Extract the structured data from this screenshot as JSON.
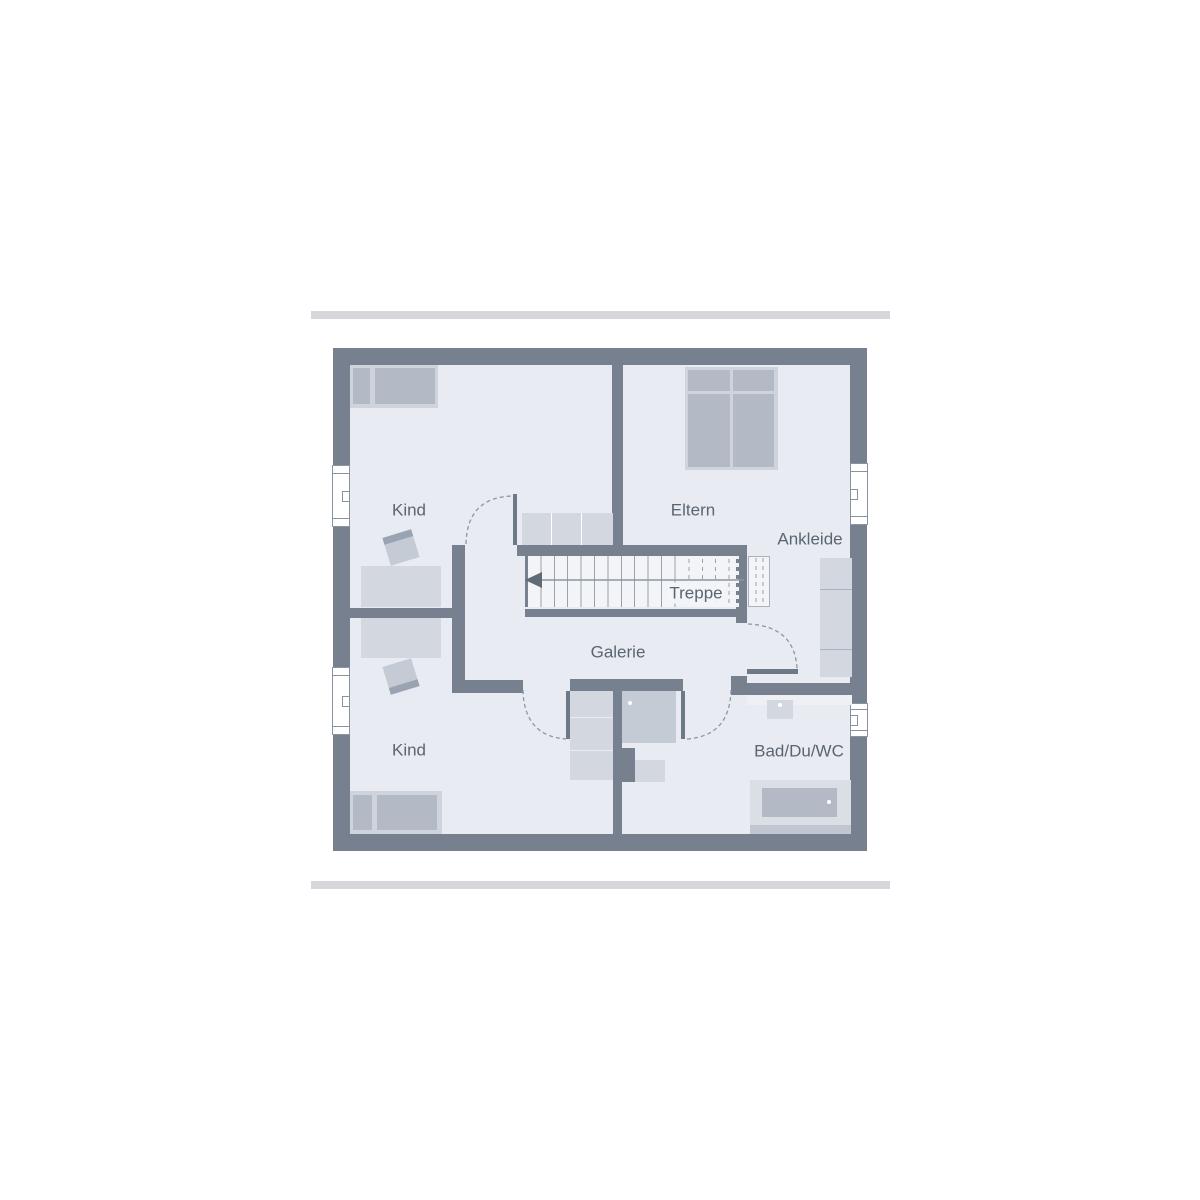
{
  "rooms": {
    "kind_top": {
      "label": "Kind"
    },
    "eltern": {
      "label": "Eltern"
    },
    "ankleide": {
      "label": "Ankleide"
    },
    "treppe": {
      "label": "Treppe"
    },
    "galerie": {
      "label": "Galerie"
    },
    "kind_bottom": {
      "label": "Kind"
    },
    "bad": {
      "label": "Bad/Du/WC"
    }
  },
  "icons": {
    "stair_direction_arrow": "left-arrow"
  },
  "colors": {
    "background": "#ffffff",
    "accent_bar": "#d5d7db",
    "wall": "#76808e",
    "room_fill": "#e8ebf1",
    "stair_fill": "#f3f4f7",
    "furniture_light": "#d3d8e0",
    "furniture_mid": "#c5cbd5",
    "furniture_dark": "#b3bac6",
    "bed_frame": "#ced3dc",
    "window_frame": "#8a94a1",
    "label_text": "#5b6571",
    "door_swing": "#8d96a3",
    "tread_line": "#9aa2ae",
    "door_leaf": "#6d7987",
    "chair_back": "#9aa3b1"
  }
}
